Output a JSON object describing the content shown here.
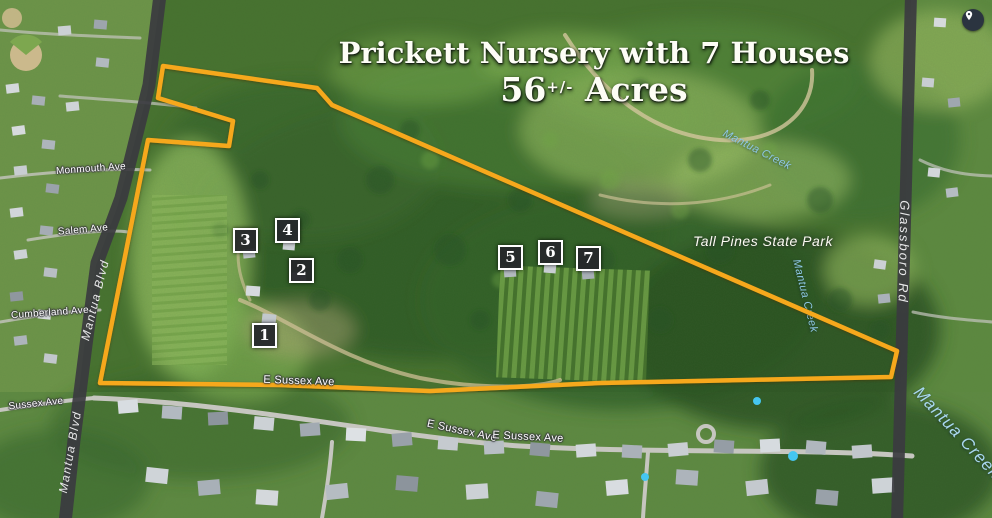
{
  "title": {
    "line1": "Prickett Nursery with 7 Houses",
    "acres_value": "56",
    "acres_tolerance": "+/-",
    "acres_unit": "Acres"
  },
  "markers": [
    {
      "label": "1"
    },
    {
      "label": "2"
    },
    {
      "label": "3"
    },
    {
      "label": "4"
    },
    {
      "label": "5"
    },
    {
      "label": "6"
    },
    {
      "label": "7"
    }
  ],
  "labels": {
    "park": "Tall Pines State Park",
    "creek": "Mantua Creek",
    "roads": {
      "mantua_blvd": "Mantua Blvd",
      "glassboro_rd": "Glassboro Rd"
    },
    "streets": {
      "e_sussex_ave": "E Sussex Ave",
      "sussex_ave": "Sussex Ave",
      "cumberland_ave": "Cumberland Ave",
      "salem_ave": "Salem Ave",
      "monmouth_ave": "Monmouth Ave"
    }
  },
  "icons": {
    "top_right": "location-pin"
  },
  "palette": {
    "boundary": "#F6A81C",
    "road_ribbon": "#3B3B40",
    "creek_label": "#8FC8E4",
    "park_label": "#FCFBF3",
    "street_label": "#FFFFFF",
    "marker_bg": "#26282B",
    "marker_border": "#FFFFFF",
    "title_color": "#FDFDF6"
  }
}
